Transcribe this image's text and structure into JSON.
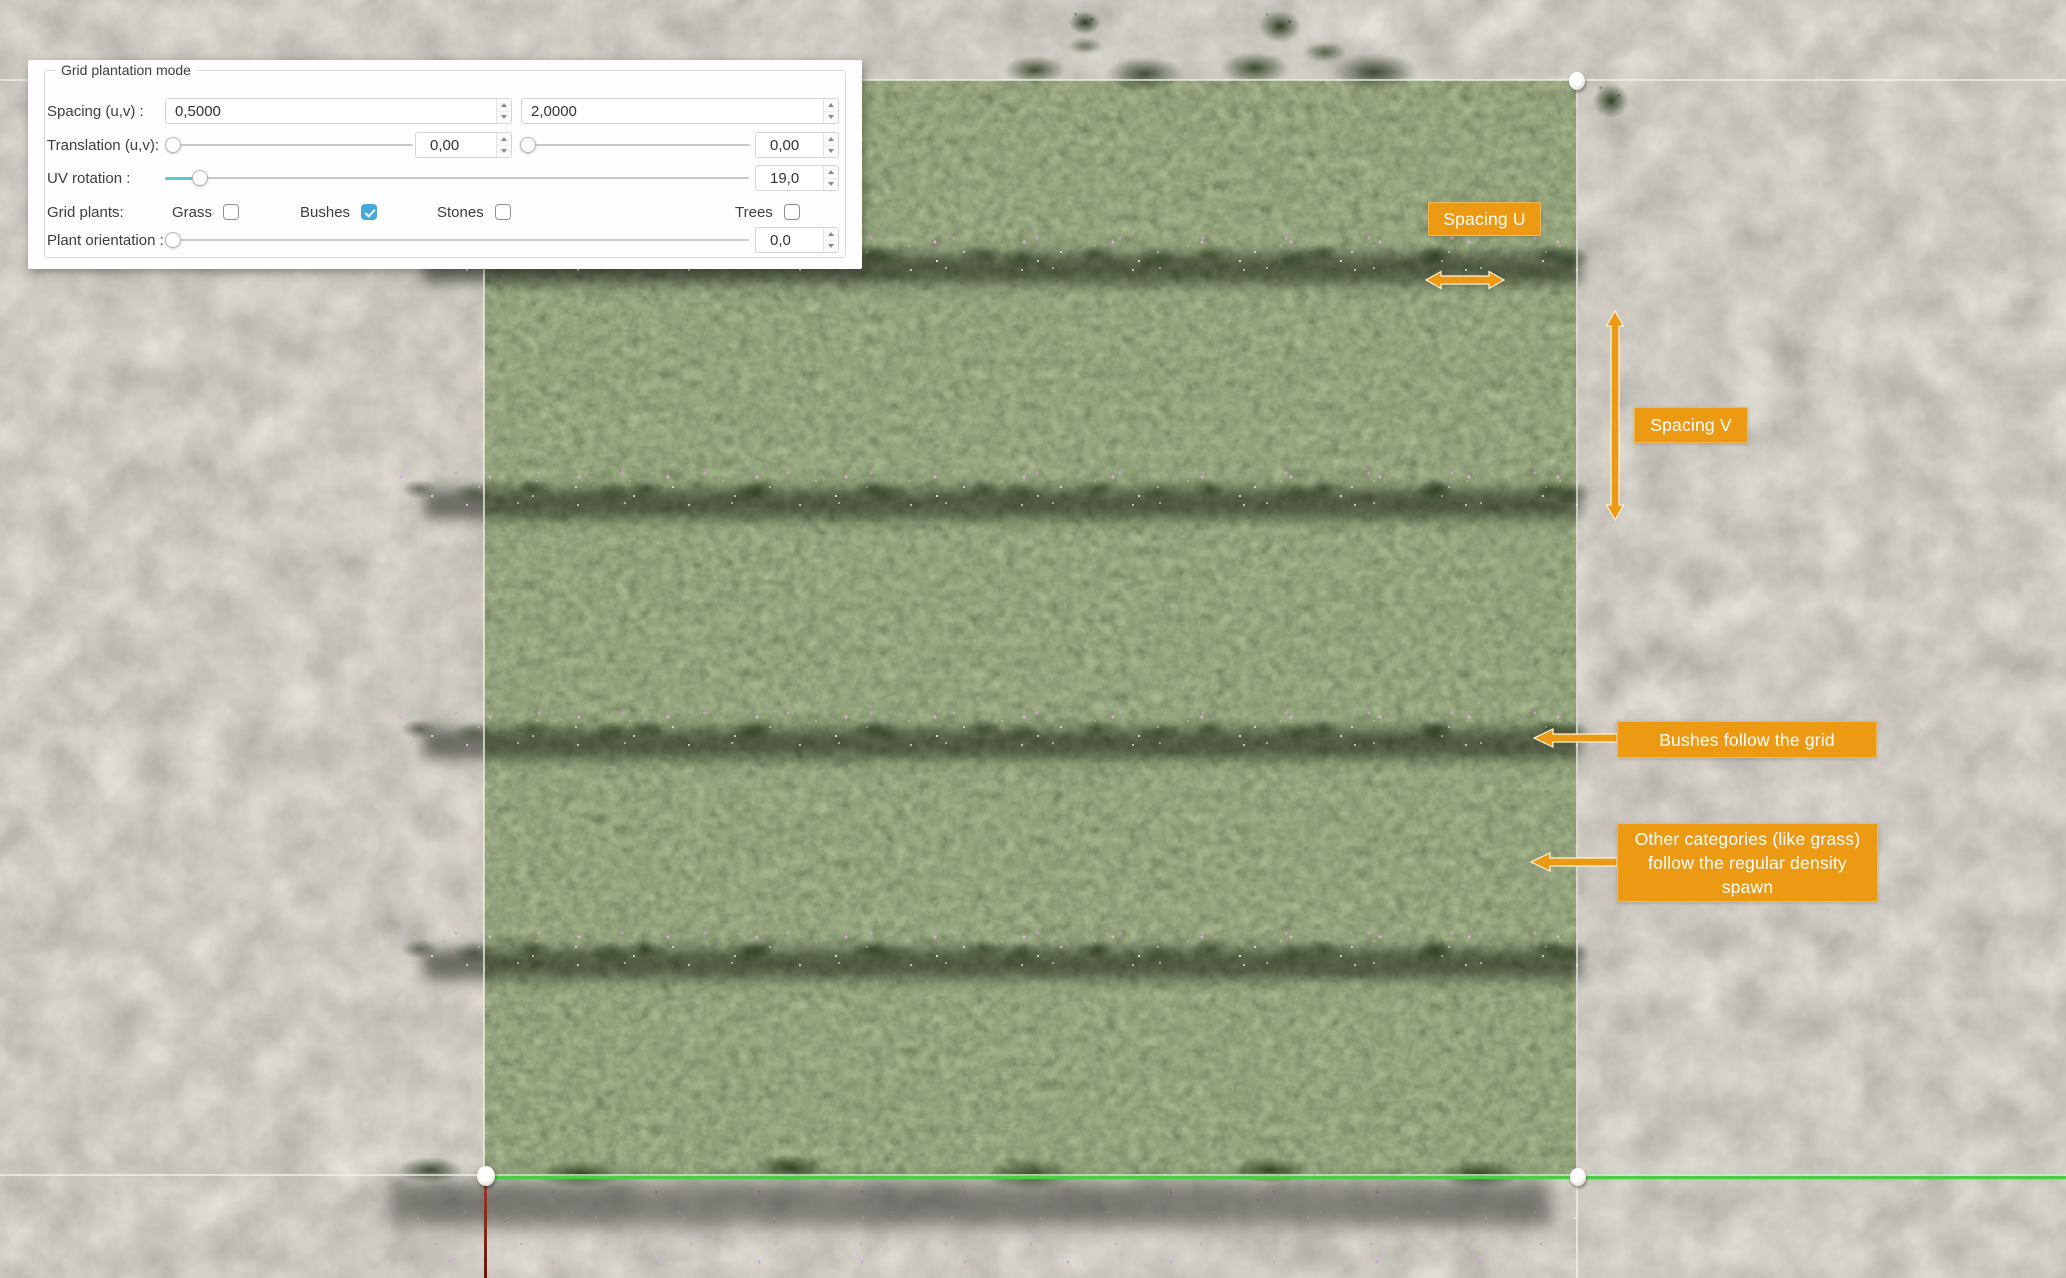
{
  "panel": {
    "legend": "Grid plantation mode",
    "spacing": {
      "label": "Spacing (u,v) :",
      "u_value": "0,5000",
      "v_value": "2,0000"
    },
    "translation": {
      "label": "Translation (u,v):",
      "u_value": "0,00",
      "v_value": "0,00"
    },
    "uv_rotation": {
      "label": "UV rotation :",
      "value": "19,0"
    },
    "grid_plants": {
      "label": "Grid plants:",
      "options": [
        {
          "label": "Grass",
          "checked": false
        },
        {
          "label": "Bushes",
          "checked": true
        },
        {
          "label": "Stones",
          "checked": false
        },
        {
          "label": "Trees",
          "checked": false
        }
      ]
    },
    "plant_orientation": {
      "label": "Plant orientation :",
      "value": "0,0"
    }
  },
  "annotations": {
    "spacing_u": {
      "text": "Spacing U"
    },
    "spacing_v": {
      "text": "Spacing V"
    },
    "bushes_follow": {
      "text": "Bushes follow the grid"
    },
    "other_categories": {
      "text": "Other categories (like grass) follow the regular density spawn"
    }
  },
  "colors": {
    "annotation_orange": "#EC9A14",
    "checkbox_checked_blue": "#45A7DA",
    "slider_fill_cyan": "#5AC8D2",
    "axis_green": "#4CCC44",
    "axis_red": "#9B3A2C",
    "selection_line": "#F2F1E8",
    "gravel_base": "#9A9183",
    "field_green": "#42562B"
  }
}
